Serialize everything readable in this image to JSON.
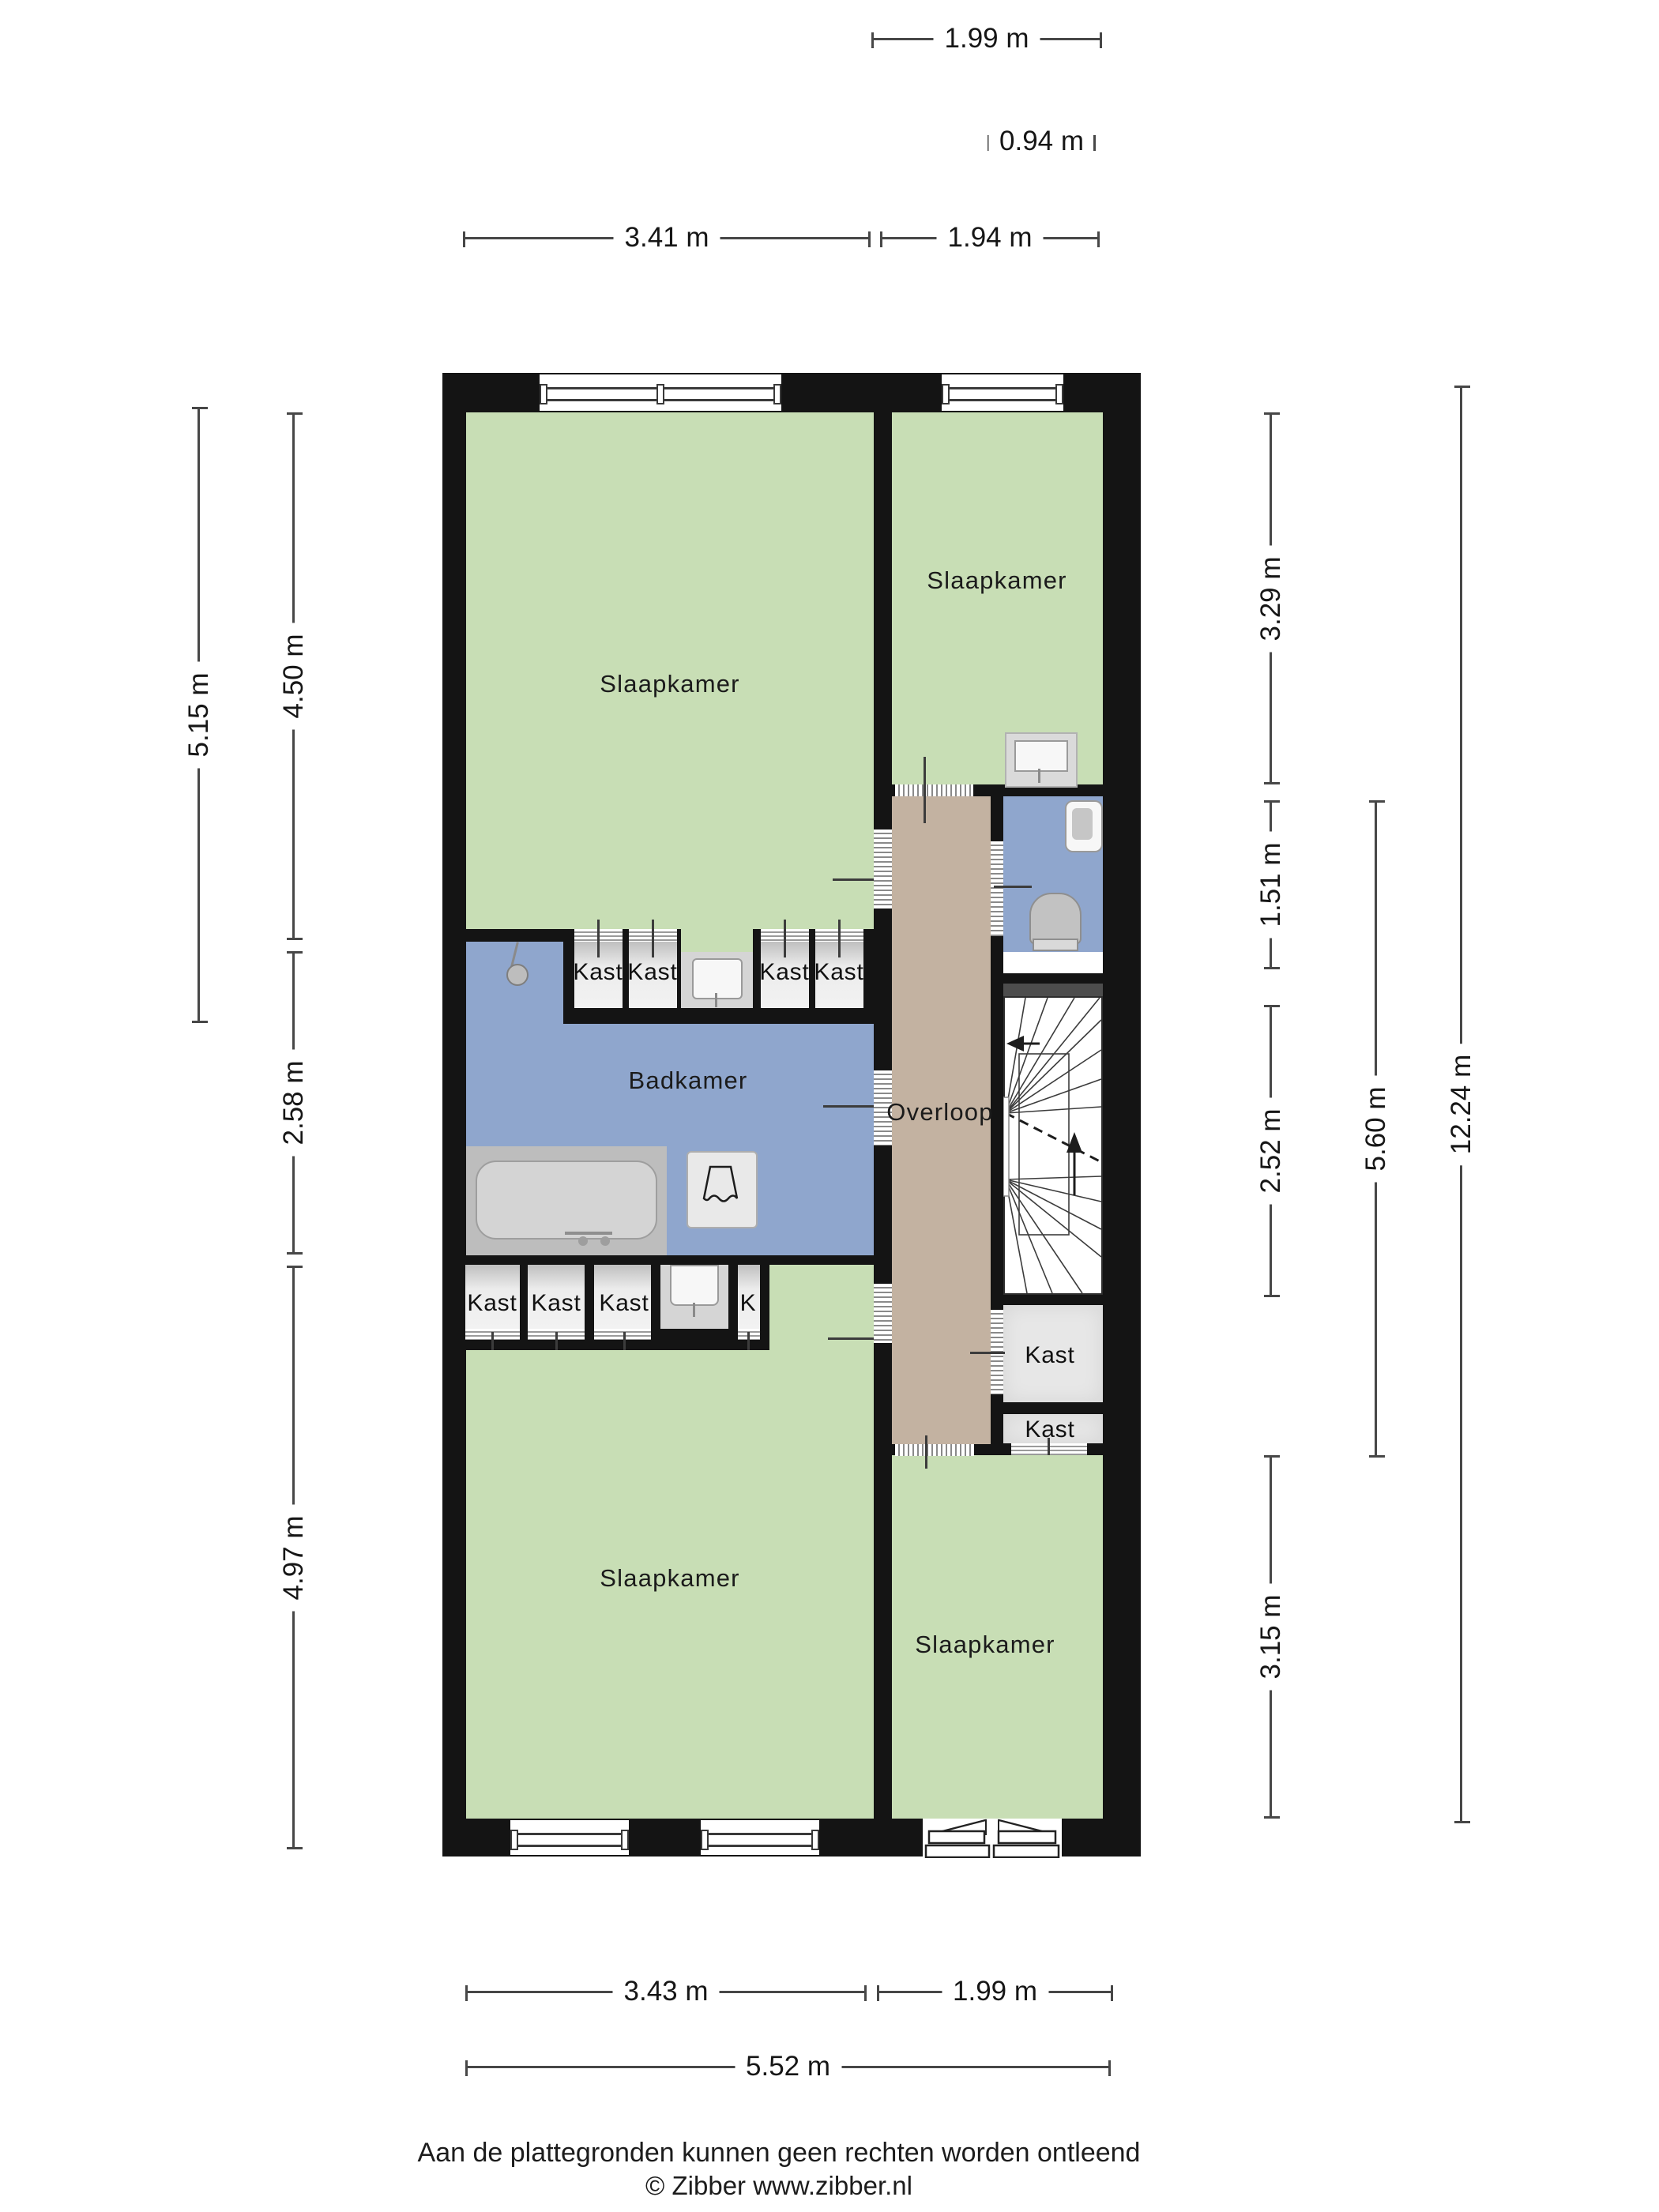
{
  "rooms": {
    "bedroom_top_left": "Slaapkamer",
    "bedroom_top_right": "Slaapkamer",
    "bathroom": "Badkamer",
    "landing": "Overloop",
    "bedroom_bottom_left": "Slaapkamer",
    "bedroom_bottom_right": "Slaapkamer"
  },
  "closets": {
    "row_top": [
      "Kast",
      "Kast",
      "Kast",
      "Kast"
    ],
    "row_bottom": [
      "Kast",
      "Kast",
      "Kast",
      "K"
    ],
    "right_large": "Kast",
    "right_small": "Kast"
  },
  "dimensions": {
    "top": [
      "1.99 m",
      "0.94 m",
      "3.41 m",
      "1.94 m"
    ],
    "left": [
      "5.15 m",
      "4.50 m",
      "2.58 m",
      "4.97 m"
    ],
    "right": [
      "3.29 m",
      "1.51 m",
      "2.52 m",
      "3.15 m",
      "5.60 m",
      "12.24 m"
    ],
    "bottom": [
      "3.43 m",
      "1.99 m",
      "5.52 m"
    ]
  },
  "footer": {
    "disclaimer": "Aan de plattegronden kunnen geen rechten worden ontleend",
    "copyright": "© Zibber www.zibber.nl"
  },
  "colors": {
    "wall": "#141414",
    "room_green": "#c8deb5",
    "wet_room_blue": "#8fa6cd",
    "landing_tan": "#c3b2a1",
    "closet_gray": "#e7e7e7",
    "step_strip_gray": "#4d4d4d"
  }
}
